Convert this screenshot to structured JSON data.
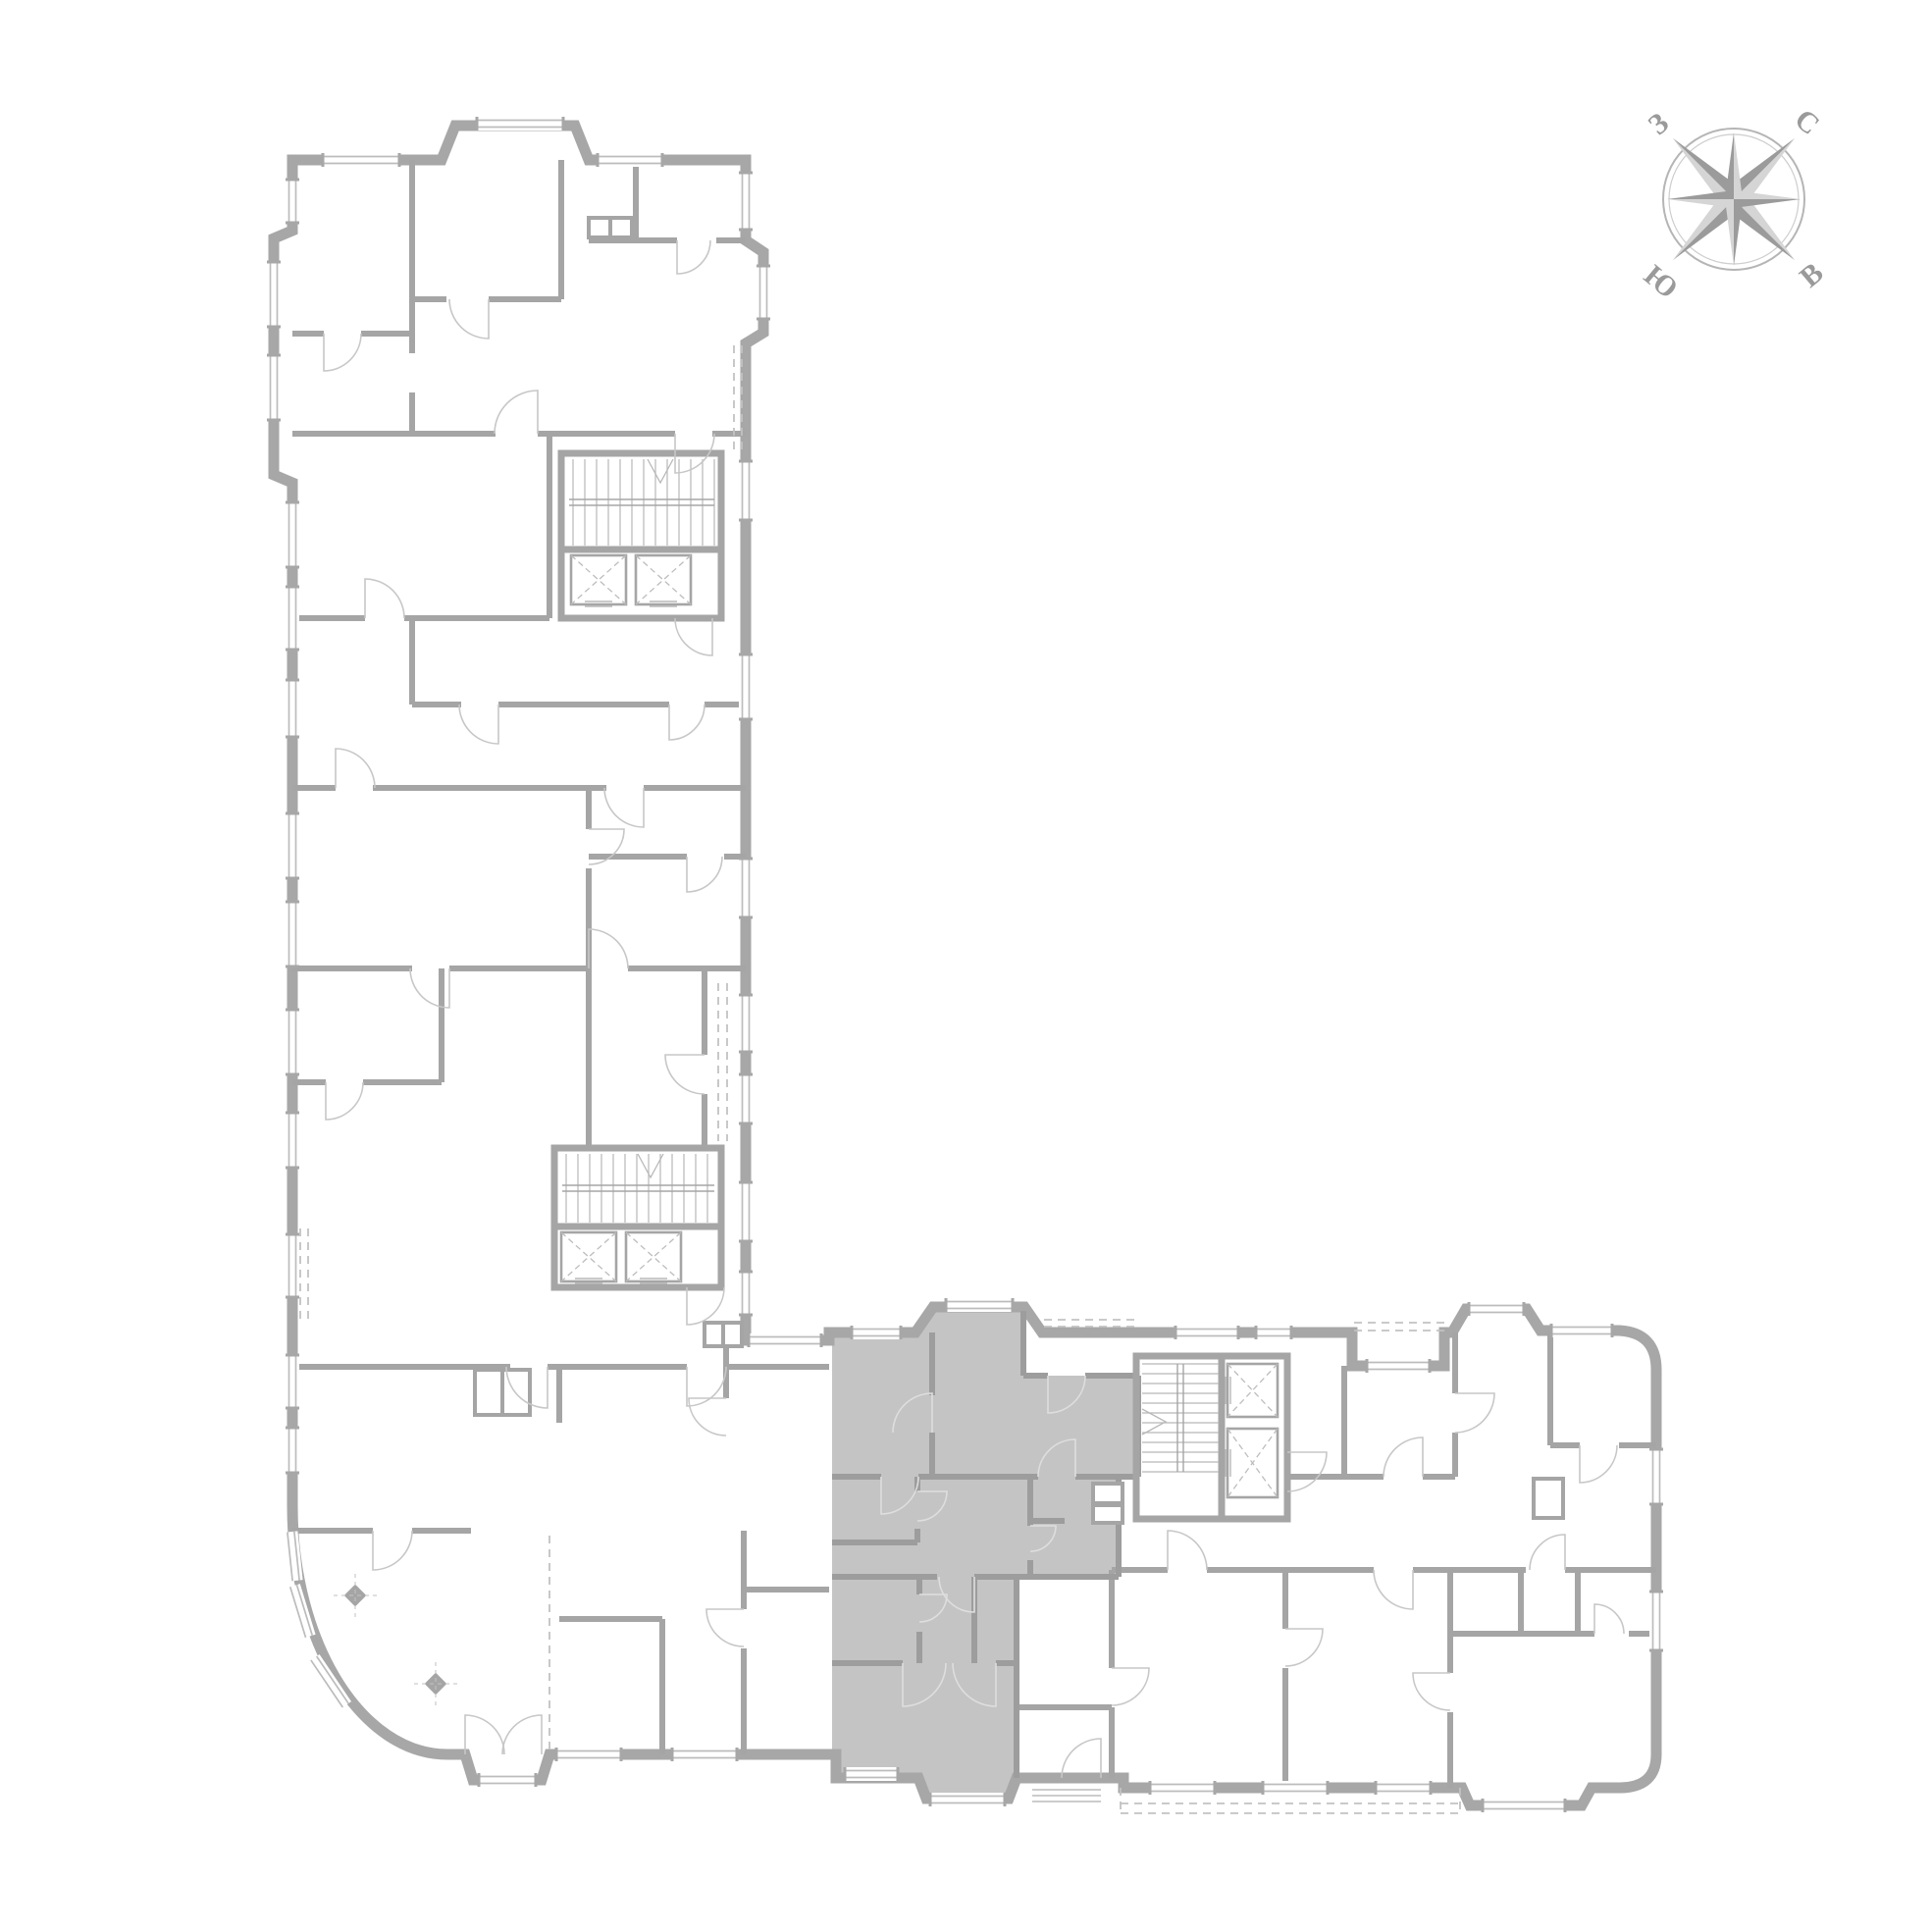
{
  "compass": {
    "north_label": "С",
    "east_label": "В",
    "south_label": "Ю",
    "west_label": "З"
  },
  "colors": {
    "background": "#ffffff",
    "outer_wall": "#a7a7a7",
    "interior_wall": "#a5a5a5",
    "unit_fill": "#c4c4c4",
    "unit_wall": "#9d9d9d",
    "window_glass": "#bcbcbc",
    "door_arc": "#c7c7c7",
    "door_arc_on_unit": "#dedede",
    "balcony_dash": "#c2c2c2",
    "stair_tread": "#b8b8b8",
    "compass_dark": "#9b9b9b",
    "compass_light": "#d5d5d5",
    "compass_ring": "#b5b5b5",
    "compass_text": "#9a9a9a"
  },
  "plan_symbols": {
    "highlighted_unit_present": true,
    "elevator_count": 6,
    "staircase_count": 3,
    "column_count": 2
  }
}
